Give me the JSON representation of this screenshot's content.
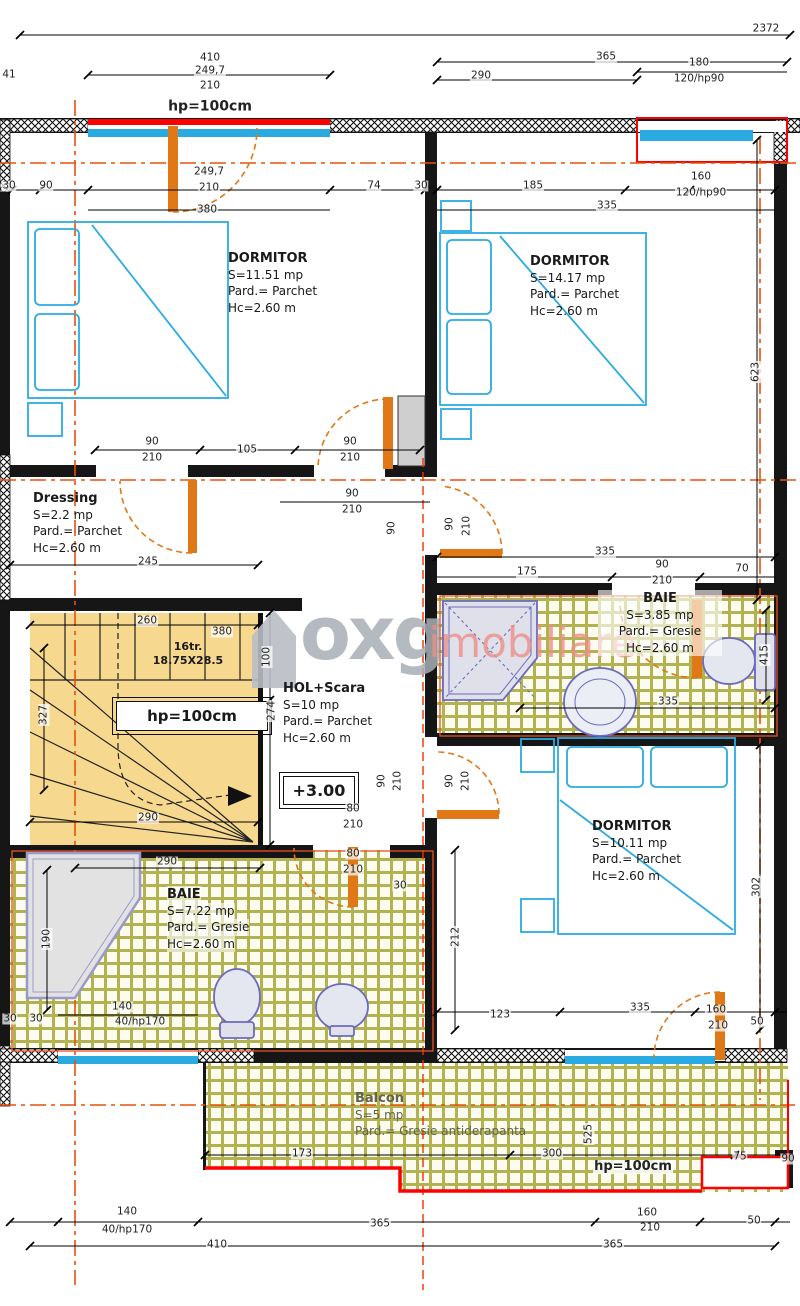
{
  "watermark": {
    "brand": "oxg",
    "suffix": "imobiliare"
  },
  "rooms": [
    {
      "name": "DORMITOR",
      "area": "S=11.51 mp",
      "floor": "Pard.= Parchet",
      "height": "Hc=2.60 m"
    },
    {
      "name": "DORMITOR",
      "area": "S=14.17 mp",
      "floor": "Pard.= Parchet",
      "height": "Hc=2.60 m"
    },
    {
      "name": "Dressing",
      "area": "S=2.2 mp",
      "floor": "Pard.= Parchet",
      "height": "Hc=2.60 m"
    },
    {
      "name": "HOL+Scara",
      "area": "S=10 mp",
      "floor": "Pard.= Parchet",
      "height": "Hc=2.60 m"
    },
    {
      "name": "BAIE",
      "area": "S=3.85 mp",
      "floor": "Pard.= Gresie",
      "height": "Hc=2.60 m"
    },
    {
      "name": "DORMITOR",
      "area": "S=10.11 mp",
      "floor": "Pard.= Parchet",
      "height": "Hc=2.60 m"
    },
    {
      "name": "BAIE",
      "area": "S=7.22 mp",
      "floor": "Pard.= Gresie",
      "height": "Hc=2.60 m"
    },
    {
      "name": "Balcon",
      "area": "S=5 mp",
      "floor": "Pard.= Gresie antiderapanta",
      "height": ""
    }
  ],
  "stairs": {
    "treads": "16tr.",
    "step_size": "18.75X28.5",
    "parapet_label": "hp=100cm"
  },
  "level_marker": "+3.00",
  "colors": {
    "wall": "#161616",
    "window": "#29aae1",
    "door": "#e07818",
    "axis": "#e8500a",
    "parapet_red": "#ff0000",
    "stairs_fill": "#f6d88e",
    "tile_joint": "#b2b250",
    "fixture_stroke": "#6b6bbd",
    "watermark_gray": "#a9afb6",
    "watermark_pink": "#ef8f88"
  },
  "dims": [
    {
      "t": "2372",
      "x": 766,
      "y": 29
    },
    {
      "t": "41",
      "x": 9,
      "y": 75
    },
    {
      "t": "410",
      "x": 210,
      "y": 58
    },
    {
      "t": "249,7",
      "x": 210,
      "y": 71
    },
    {
      "t": "210",
      "x": 210,
      "y": 86
    },
    {
      "t": "hp=100cm",
      "x": 210,
      "y": 107,
      "b": 1,
      "s": 14
    },
    {
      "t": "365",
      "x": 606,
      "y": 57
    },
    {
      "t": "290",
      "x": 481,
      "y": 76
    },
    {
      "t": "180",
      "x": 699,
      "y": 63
    },
    {
      "t": "120/hp90",
      "x": 699,
      "y": 79
    },
    {
      "t": "30",
      "x": 9,
      "y": 186
    },
    {
      "t": "90",
      "x": 46,
      "y": 186
    },
    {
      "t": "249,7",
      "x": 209,
      "y": 172
    },
    {
      "t": "210",
      "x": 209,
      "y": 188
    },
    {
      "t": "380",
      "x": 207,
      "y": 210
    },
    {
      "t": "74",
      "x": 374,
      "y": 186
    },
    {
      "t": "30",
      "x": 421,
      "y": 186
    },
    {
      "t": "185",
      "x": 533,
      "y": 186
    },
    {
      "t": "160",
      "x": 701,
      "y": 177
    },
    {
      "t": "120/hp90",
      "x": 701,
      "y": 193
    },
    {
      "t": "335",
      "x": 607,
      "y": 206
    },
    {
      "t": "623",
      "x": 756,
      "y": 372,
      "r": 1
    },
    {
      "t": "90",
      "x": 152,
      "y": 442
    },
    {
      "t": "210",
      "x": 152,
      "y": 458
    },
    {
      "t": "105",
      "x": 247,
      "y": 450
    },
    {
      "t": "90",
      "x": 350,
      "y": 442
    },
    {
      "t": "210",
      "x": 350,
      "y": 458
    },
    {
      "t": "90",
      "x": 352,
      "y": 494
    },
    {
      "t": "210",
      "x": 352,
      "y": 510
    },
    {
      "t": "90",
      "x": 392,
      "y": 528,
      "r": 1
    },
    {
      "t": "90",
      "x": 450,
      "y": 524,
      "r": 1
    },
    {
      "t": "210",
      "x": 467,
      "y": 526,
      "r": 1
    },
    {
      "t": "245",
      "x": 148,
      "y": 562
    },
    {
      "t": "335",
      "x": 605,
      "y": 552
    },
    {
      "t": "175",
      "x": 527,
      "y": 572
    },
    {
      "t": "90",
      "x": 662,
      "y": 565
    },
    {
      "t": "210",
      "x": 662,
      "y": 581
    },
    {
      "t": "70",
      "x": 742,
      "y": 569
    },
    {
      "t": "415",
      "x": 765,
      "y": 655,
      "r": 1
    },
    {
      "t": "335",
      "x": 668,
      "y": 702
    },
    {
      "t": "260",
      "x": 147,
      "y": 621
    },
    {
      "t": "380",
      "x": 222,
      "y": 632
    },
    {
      "t": "327",
      "x": 44,
      "y": 715,
      "r": 1
    },
    {
      "t": "100",
      "x": 267,
      "y": 657,
      "r": 1
    },
    {
      "t": "274",
      "x": 272,
      "y": 711,
      "r": 1
    },
    {
      "t": "290",
      "x": 148,
      "y": 818
    },
    {
      "t": "80",
      "x": 353,
      "y": 809
    },
    {
      "t": "210",
      "x": 353,
      "y": 825
    },
    {
      "t": "80",
      "x": 353,
      "y": 854
    },
    {
      "t": "210",
      "x": 353,
      "y": 870
    },
    {
      "t": "90",
      "x": 382,
      "y": 781,
      "r": 1
    },
    {
      "t": "210",
      "x": 398,
      "y": 781,
      "r": 1
    },
    {
      "t": "90",
      "x": 450,
      "y": 781,
      "r": 1
    },
    {
      "t": "210",
      "x": 466,
      "y": 781,
      "r": 1
    },
    {
      "t": "30",
      "x": 400,
      "y": 886
    },
    {
      "t": "302",
      "x": 757,
      "y": 887,
      "r": 1
    },
    {
      "t": "290",
      "x": 167,
      "y": 862
    },
    {
      "t": "190",
      "x": 47,
      "y": 939,
      "r": 1
    },
    {
      "t": "212",
      "x": 456,
      "y": 937,
      "r": 1
    },
    {
      "t": "140",
      "x": 122,
      "y": 1007
    },
    {
      "t": "40/hp170",
      "x": 140,
      "y": 1022
    },
    {
      "t": "30",
      "x": 10,
      "y": 1019
    },
    {
      "t": "30",
      "x": 36,
      "y": 1019
    },
    {
      "t": "123",
      "x": 500,
      "y": 1015
    },
    {
      "t": "335",
      "x": 640,
      "y": 1008
    },
    {
      "t": "160",
      "x": 716,
      "y": 1010
    },
    {
      "t": "210",
      "x": 718,
      "y": 1026
    },
    {
      "t": "50",
      "x": 757,
      "y": 1022
    },
    {
      "t": "173",
      "x": 302,
      "y": 1154
    },
    {
      "t": "300",
      "x": 552,
      "y": 1154
    },
    {
      "t": "75",
      "x": 740,
      "y": 1157
    },
    {
      "t": "90",
      "x": 788,
      "y": 1159
    },
    {
      "t": "525",
      "x": 589,
      "y": 1134,
      "r": 1
    },
    {
      "t": "hp=100cm",
      "x": 633,
      "y": 1167,
      "b": 1,
      "s": 13
    },
    {
      "t": "140",
      "x": 127,
      "y": 1212
    },
    {
      "t": "40/hp170",
      "x": 127,
      "y": 1230
    },
    {
      "t": "410",
      "x": 217,
      "y": 1245
    },
    {
      "t": "365",
      "x": 380,
      "y": 1224
    },
    {
      "t": "160",
      "x": 647,
      "y": 1213
    },
    {
      "t": "210",
      "x": 650,
      "y": 1228
    },
    {
      "t": "50",
      "x": 754,
      "y": 1221
    },
    {
      "t": "365",
      "x": 613,
      "y": 1245
    }
  ]
}
